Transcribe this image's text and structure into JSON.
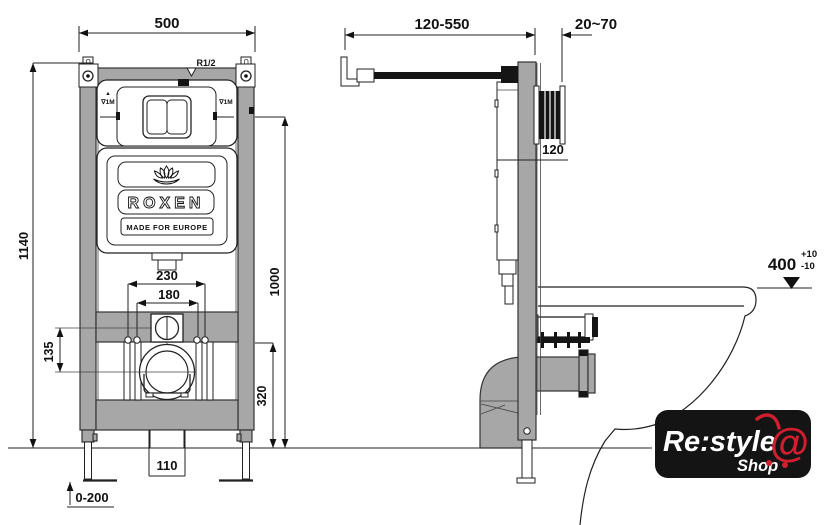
{
  "colors": {
    "frame_gray": "#a7a7a7",
    "drawing_line": "#222222",
    "logo_red": "#cf1f2f",
    "logo_bg": "#141414"
  },
  "front_view": {
    "dims": {
      "frame_width": "500",
      "frame_height": "1140",
      "meter_height": "1000",
      "drain_offset": "320",
      "bolt_outer": "230",
      "bolt_inner": "180",
      "inlet_drop": "135",
      "waste_pipe": "110",
      "foot_range": "0-200"
    },
    "labels": {
      "inlet_thread": "R1/2",
      "level_arrow": "▲",
      "level_left": "∇1M",
      "level_right": "∇1M"
    },
    "cistern": {
      "brand": "ROXEN",
      "tagline": "MADE FOR EUROPE"
    }
  },
  "side_view": {
    "dims": {
      "bracket_range": "120-550",
      "plate_depth": "20~70",
      "tank_depth": "120",
      "bowl_height": "400",
      "tol_plus": "+10",
      "tol_minus": "-10"
    }
  },
  "watermark": {
    "name": "Re:style",
    "shop": "Shop",
    "at": "@"
  }
}
